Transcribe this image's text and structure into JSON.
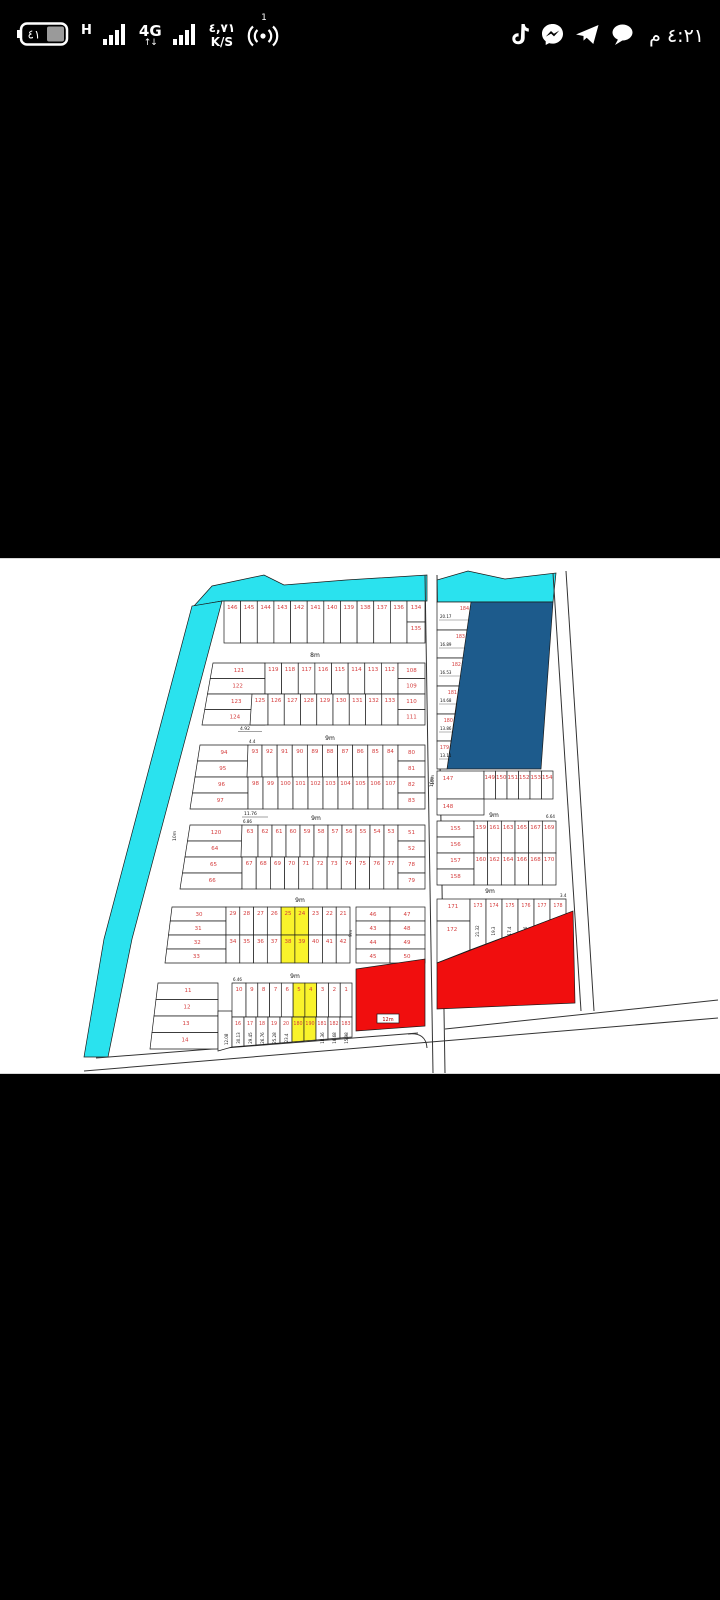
{
  "status_bar": {
    "battery_level": "٤١",
    "net_h": "H",
    "net_4g": "4G",
    "net_arrows": "↑↓",
    "speed_value": "٤,٧١",
    "speed_unit": "K/S",
    "hotspot_badge": "1",
    "time": "٤:٢١ م"
  },
  "map": {
    "colors": {
      "water": "#2ae2ee",
      "reserved": "#1d5b8c",
      "highlight": "#f9f32b",
      "sold": "#f10e0e",
      "plot_number": "#d43c3c",
      "line": "#1a1a1a"
    },
    "street_labels": {
      "s1": "8m",
      "s2": "9m",
      "s3": "9m",
      "s4": "9m",
      "s5": "9m",
      "v_road": "10m",
      "left_b4": "10m",
      "mid": "9m",
      "right_b": "9m",
      "right_c": "9m",
      "red_pill": "12m"
    },
    "block1": {
      "row": [
        "146",
        "145",
        "144",
        "143",
        "142",
        "141",
        "140",
        "139",
        "138",
        "137",
        "136"
      ],
      "right": [
        "134",
        "135"
      ]
    },
    "block2": {
      "left": [
        "121",
        "122",
        "123",
        "124"
      ],
      "narrow": "125",
      "top": [
        "119",
        "118",
        "117",
        "116",
        "115",
        "114",
        "113",
        "112"
      ],
      "bottom": [
        "126",
        "127",
        "128",
        "129",
        "130",
        "131",
        "132",
        "133"
      ],
      "right": [
        "108",
        "109",
        "110",
        "111"
      ],
      "dim": "4.92"
    },
    "block3": {
      "left": [
        "94",
        "95",
        "96",
        "97"
      ],
      "narrow": {
        "n": "93",
        "d": "4.4"
      },
      "top": [
        "92",
        "91",
        "90",
        "89",
        "88",
        "87",
        "86",
        "85",
        "84"
      ],
      "bottom": [
        "98",
        "99",
        "100",
        "101",
        "102",
        "103",
        "104",
        "105",
        "106",
        "107"
      ],
      "right": [
        "80",
        "81",
        "82",
        "83"
      ],
      "dim": "11.76"
    },
    "block4": {
      "left": [
        "120",
        "64",
        "65",
        "66"
      ],
      "narrow": {
        "n": "63",
        "d": "6.86"
      },
      "top": [
        "62",
        "61",
        "60",
        "59",
        "58",
        "57",
        "56",
        "55",
        "54",
        "53"
      ],
      "bottom": [
        "67",
        "68",
        "69",
        "70",
        "71",
        "72",
        "73",
        "74",
        "75",
        "76",
        "77"
      ],
      "right": [
        "51",
        "52",
        "78",
        "79"
      ]
    },
    "block5": {
      "left": [
        "30",
        "31",
        "32",
        "33"
      ],
      "top": [
        "29",
        "28",
        "27",
        "26",
        "25",
        "24",
        "23",
        "22",
        "21"
      ],
      "bottom": [
        "34",
        "35",
        "36",
        "37",
        "38",
        "39",
        "40",
        "41",
        "42"
      ],
      "highlight_top": [
        "25",
        "24"
      ],
      "highlight_bottom": [
        "38",
        "39"
      ]
    },
    "block6": {
      "left": [
        "11",
        "12",
        "13",
        "14"
      ],
      "left_dim": "12.08",
      "narrow": {
        "n": "10",
        "d": "6.46"
      },
      "top": [
        "9",
        "8",
        "7",
        "6",
        "5",
        "4",
        "3",
        "2",
        "1"
      ],
      "highlight_top": [
        "5",
        "4"
      ],
      "strips": [
        {
          "n": "16",
          "d": "30.13",
          "hl": false
        },
        {
          "n": "17",
          "d": "29.45",
          "hl": false
        },
        {
          "n": "18",
          "d": "26.76",
          "hl": false
        },
        {
          "n": "19",
          "d": "25.28",
          "hl": false
        },
        {
          "n": "20",
          "d": "23.4",
          "hl": false
        },
        {
          "n": "180",
          "d": "",
          "hl": true
        },
        {
          "n": "190",
          "d": "",
          "hl": true
        },
        {
          "n": "181",
          "d": "18.36",
          "hl": false
        },
        {
          "n": "182",
          "d": "16.68",
          "hl": false
        },
        {
          "n": "183",
          "d": "15.98",
          "hl": false
        }
      ]
    },
    "mid_block": {
      "rows": [
        [
          "46",
          "47"
        ],
        [
          "43",
          "48"
        ],
        [
          "44",
          "49"
        ],
        [
          "45",
          "50"
        ]
      ]
    },
    "right_top_column": [
      {
        "n": "184",
        "d": "20.17"
      },
      {
        "n": "183",
        "d": "16.89"
      },
      {
        "n": "182",
        "d": "16.53"
      },
      {
        "n": "181",
        "d": "14.68"
      },
      {
        "n": "180",
        "d": "13.86"
      },
      {
        "n": "179",
        "d": "13.11"
      }
    ],
    "right_row_147": {
      "left": "147",
      "below": "148",
      "row": [
        "149",
        "150",
        "151",
        "152",
        "153",
        "154"
      ]
    },
    "right_block_b": {
      "left": [
        "155",
        "156",
        "157",
        "158"
      ],
      "top": [
        "159",
        "161",
        "163",
        "165",
        "167",
        "169"
      ],
      "bottom": [
        "160",
        "162",
        "164",
        "166",
        "168",
        "170"
      ],
      "dim": "6.64"
    },
    "right_block_c": {
      "left": [
        "171",
        "172"
      ],
      "dim": "3.4",
      "strips": [
        {
          "n": "173",
          "d": "21.32"
        },
        {
          "n": "174",
          "d": "19.3"
        },
        {
          "n": "175",
          "d": "17.4"
        },
        {
          "n": "176",
          "d": "15.6"
        },
        {
          "n": "177",
          "d": "13.9"
        },
        {
          "n": "178",
          "d": ""
        }
      ]
    }
  }
}
